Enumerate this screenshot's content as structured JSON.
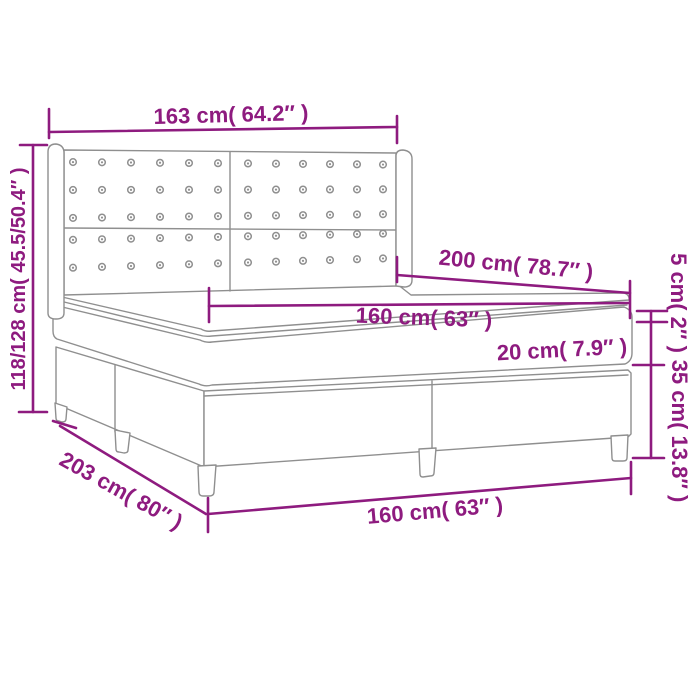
{
  "diagram": {
    "subject": "box-spring-bed-dimension-diagram",
    "labels": {
      "headboard_width": "163 cm( 64.2″ )",
      "overall_height": "118/128 cm( 45.5/50.4″ )",
      "bed_length": "200 cm( 78.7″ )",
      "topper_height": "5 cm( 2″ )",
      "mattress_width": "160 cm( 63″ )",
      "mattress_height": "20 cm( 7.9″ )",
      "base_height": "35 cm( 13.8″ )",
      "overall_length": "203 cm( 80″ )",
      "base_width": "160 cm( 63″ )"
    },
    "colors": {
      "dimension": "#8E1B7F",
      "outline": "#8F8F8F",
      "background": "#FFFFFF"
    }
  }
}
